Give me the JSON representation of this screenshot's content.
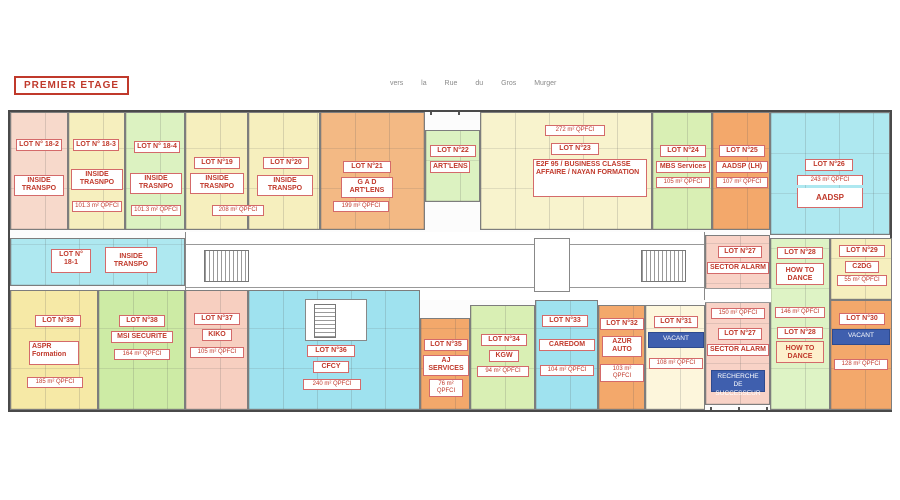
{
  "title": "PREMIER ETAGE",
  "street_label": "vers la Rue du Gros Murger",
  "palette": {
    "red_text": "#c0392b",
    "badge_blue": "#3f5fae",
    "wall": "#4a4a4a"
  },
  "lots": {
    "l18_1": {
      "label": "LOT N° 18-1",
      "name": "INSIDE TRANSPO",
      "color": "#aee8f0"
    },
    "l18_2": {
      "label": "LOT N° 18-2",
      "name": "INSIDE TRANSPO",
      "color": "#f7d9cb"
    },
    "l18_3": {
      "label": "LOT N° 18-3",
      "name": "INSIDE TRASNPO",
      "area": "101.3 m² QPFCI",
      "color": "#f6efbe"
    },
    "l18_4": {
      "label": "LOT N° 18-4",
      "name": "INSIDE TRASNPO",
      "area": "101.3 m² QPFCI",
      "color": "#dcf2c1"
    },
    "l19": {
      "label": "LOT N°19",
      "name": "INSIDE TRASNPO",
      "area": "208 m² QPFCI",
      "color": "#f6efbe"
    },
    "l20": {
      "label": "LOT N°20",
      "name": "INSIDE TRANSPO",
      "color": "#f6efbe"
    },
    "l21": {
      "label": "LOT N°21",
      "name": "G A D ART'LENS",
      "area": "199 m² QPFCI",
      "color": "#f3b984"
    },
    "l22": {
      "label": "LOT N°22",
      "name": "ART'LENS",
      "color": "#dcf2c1"
    },
    "l23": {
      "label": "LOT N°23",
      "name": "E2F 95 / BUSINESS CLASSE AFFAIRE / NAYAN FORMATION",
      "area": "272 m² QPFCI",
      "color": "#f8f3cd"
    },
    "l24": {
      "label": "LOT N°24",
      "name": "MBS Services",
      "area": "105 m² QPFCI",
      "color": "#d9efb4"
    },
    "l25": {
      "label": "LOT N°25",
      "name": "AADSP (LH)",
      "area": "107 m² QPFCI",
      "color": "#f3a86b"
    },
    "l26": {
      "label": "LOT N°26",
      "name": "AADSP",
      "area": "243 m² QPFCI",
      "color": "#aee8f0"
    },
    "l27": {
      "label": "LOT N°27",
      "name": "SECTOR ALARM",
      "area": "150 m² QPFCI",
      "badge": "RECHERCHE DE SUCCESSEUR",
      "color": "#f8d2c6"
    },
    "l28": {
      "label": "LOT N°28",
      "name": "HOW TO DANCE",
      "area": "146 m² QPFCI",
      "color": "#def3c5"
    },
    "l29": {
      "label": "LOT N°29",
      "name": "C2DG",
      "area": "55 m² QPFCI",
      "color": "#f6efbe"
    },
    "l30": {
      "label": "LOT N°30",
      "badge": "VACANT",
      "area": "128 m² QPFCI",
      "color": "#f3a86b"
    },
    "l31": {
      "label": "LOT N°31",
      "badge": "VACANT",
      "area": "108 m² QPFCI",
      "color": "#fdf6dc"
    },
    "l32": {
      "label": "LOT N°32",
      "name": "AZUR AUTO",
      "area": "103 m² QPFCI",
      "color": "#f3a86b"
    },
    "l33": {
      "label": "LOT N°33",
      "name": "CAREDOM",
      "area": "104 m² QPFCI",
      "color": "#9fe2ef"
    },
    "l34": {
      "label": "LOT N°34",
      "name": "KGW",
      "area": "94 m² QPFCI",
      "color": "#d9efb4"
    },
    "l35": {
      "label": "LOT N°35",
      "name": "AJ SERVICES",
      "area": "76 m² QPFCI",
      "color": "#f3a86b"
    },
    "l36": {
      "label": "LOT N°36",
      "name": "CFCY",
      "area": "240 m² QPFCI",
      "color": "#9fe2ef"
    },
    "l37": {
      "label": "LOT N°37",
      "name": "KIKO",
      "area": "105 m² QPFCI",
      "color": "#f7cfc0"
    },
    "l38": {
      "label": "LOT N°38",
      "name": "MSI SECURITE",
      "area": "164 m² QPFCI",
      "color": "#cdeba5"
    },
    "l39": {
      "label": "LOT N°39",
      "name": "ASPR Formation",
      "area": "185 m² QPFCI",
      "color": "#f6e9a6"
    }
  }
}
